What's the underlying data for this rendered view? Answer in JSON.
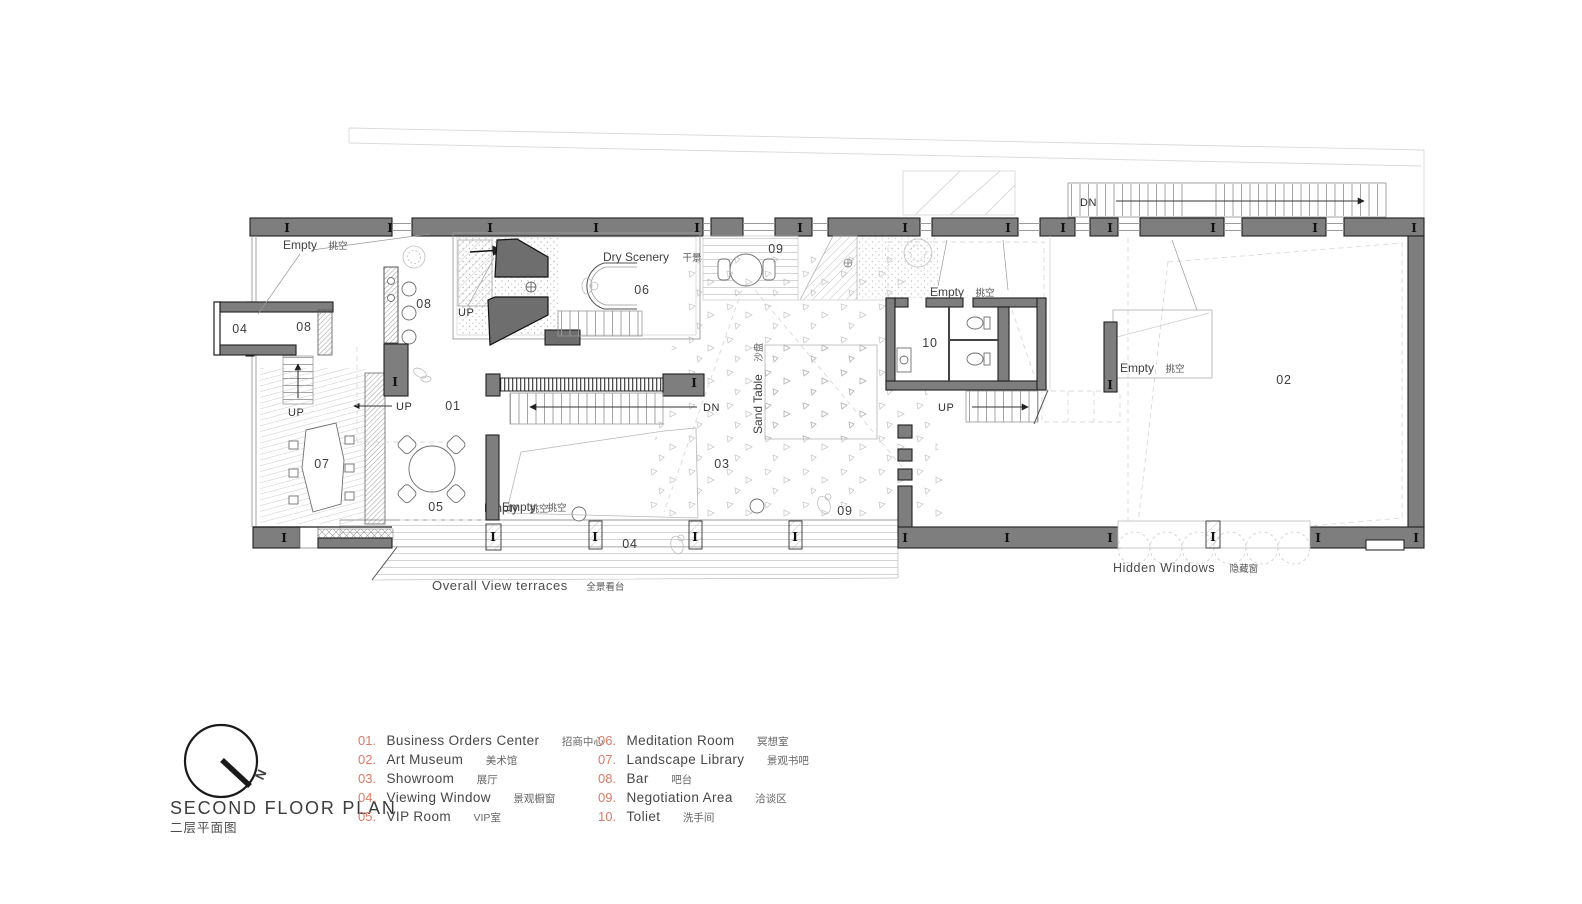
{
  "title": {
    "main": "SECOND FLOOR PLAN",
    "sub": "二层平面图"
  },
  "compass": {
    "north": "N"
  },
  "legend": {
    "items_left": [
      {
        "num": "01.",
        "name": "Business Orders Center",
        "zh": "招商中心"
      },
      {
        "num": "02.",
        "name": "Art Museum",
        "zh": "美术馆"
      },
      {
        "num": "03.",
        "name": "Showroom",
        "zh": "展厅"
      },
      {
        "num": "04.",
        "name": "Viewing Window",
        "zh": "景观橱窗"
      },
      {
        "num": "05.",
        "name": "VIP Room",
        "zh": "VIP室"
      }
    ],
    "items_right": [
      {
        "num": "06.",
        "name": "Meditation Room",
        "zh": "冥想室"
      },
      {
        "num": "07.",
        "name": "Landscape Library",
        "zh": "景观书吧"
      },
      {
        "num": "08.",
        "name": "Bar",
        "zh": "吧台"
      },
      {
        "num": "09.",
        "name": "Negotiation Area",
        "zh": "洽谈区"
      },
      {
        "num": "10.",
        "name": "Toliet",
        "zh": "洗手间"
      }
    ]
  },
  "plan": {
    "labels": {
      "empty": "Empty",
      "empty_zh": "挑空",
      "dry_scenery": "Dry Scenery",
      "dry_scenery_zh": "干景",
      "sand_table": "Sand Table",
      "sand_table_zh": "沙盘",
      "terrace": "Overall View terraces",
      "terrace_zh": "全景看台",
      "hidden_windows": "Hidden Windows",
      "hidden_windows_zh": "隐藏窗",
      "up": "UP",
      "dn": "DN",
      "column": "I"
    },
    "rooms": {
      "r01": "01",
      "r02": "02",
      "r03": "03",
      "r04": "04",
      "r05": "05",
      "r06": "06",
      "r07": "07",
      "r08": "08",
      "r09": "09",
      "r10": "10"
    }
  },
  "colors": {
    "wall": "#7e7e7e",
    "accent": "#df7a64",
    "line": "#3d3d3d"
  }
}
